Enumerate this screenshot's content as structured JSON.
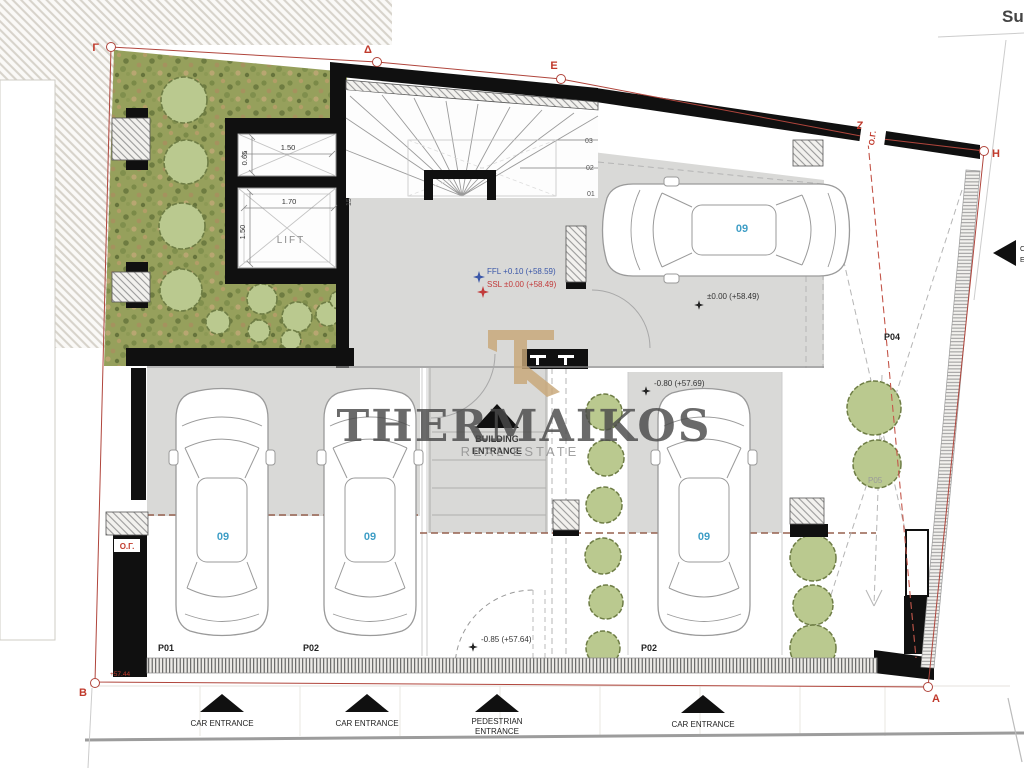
{
  "watermark": {
    "brand": "THERMAIKOS",
    "tagline": "REAL ESTATE"
  },
  "corner_text": "Su",
  "boundary_markers": {
    "g": "Γ",
    "d": "Δ",
    "e": "E",
    "z": "Z",
    "h": "H",
    "a": "A",
    "b": "B"
  },
  "building_line_labels": {
    "left": "Ο.Γ.",
    "top_right": "Ο.Γ."
  },
  "levels": {
    "ffl": "FFL +0.10 (+58.59)",
    "ssl": "SSL ±0.00 (+58.49)",
    "parking_top": "±0.00 (+58.49)",
    "parking_mid": "-0.80 (+57.69)",
    "parking_low": "-0.85 (+57.64)",
    "corner_b": "+57.44"
  },
  "lift": {
    "label": "LIFT",
    "shaft_width": "1.50",
    "shaft_depth": "0.65",
    "cab_width": "1.70",
    "cab_depth": "1.50"
  },
  "stair": {
    "tread_01": "01",
    "tread_02": "02",
    "tread_03": "03",
    "tread_15": "15"
  },
  "parking": {
    "space_1": {
      "id": "P01",
      "car_no": "09"
    },
    "space_2": {
      "id": "P02",
      "car_no": "09"
    },
    "space_3": {
      "id": "P02",
      "car_no": "09"
    },
    "space_4": {
      "id": "P04"
    },
    "space_5": {
      "id": "P05"
    },
    "top_car_no": "09"
  },
  "entrances": {
    "car": "CAR ENTRANCE",
    "pedestrian_line1": "PEDESTRIAN",
    "pedestrian_line2": "ENTRANCE",
    "building_line1": "BUILDING",
    "building_line2": "ENTRANCE",
    "side_line1": "CAR",
    "side_line2": "ENTRANCE"
  }
}
